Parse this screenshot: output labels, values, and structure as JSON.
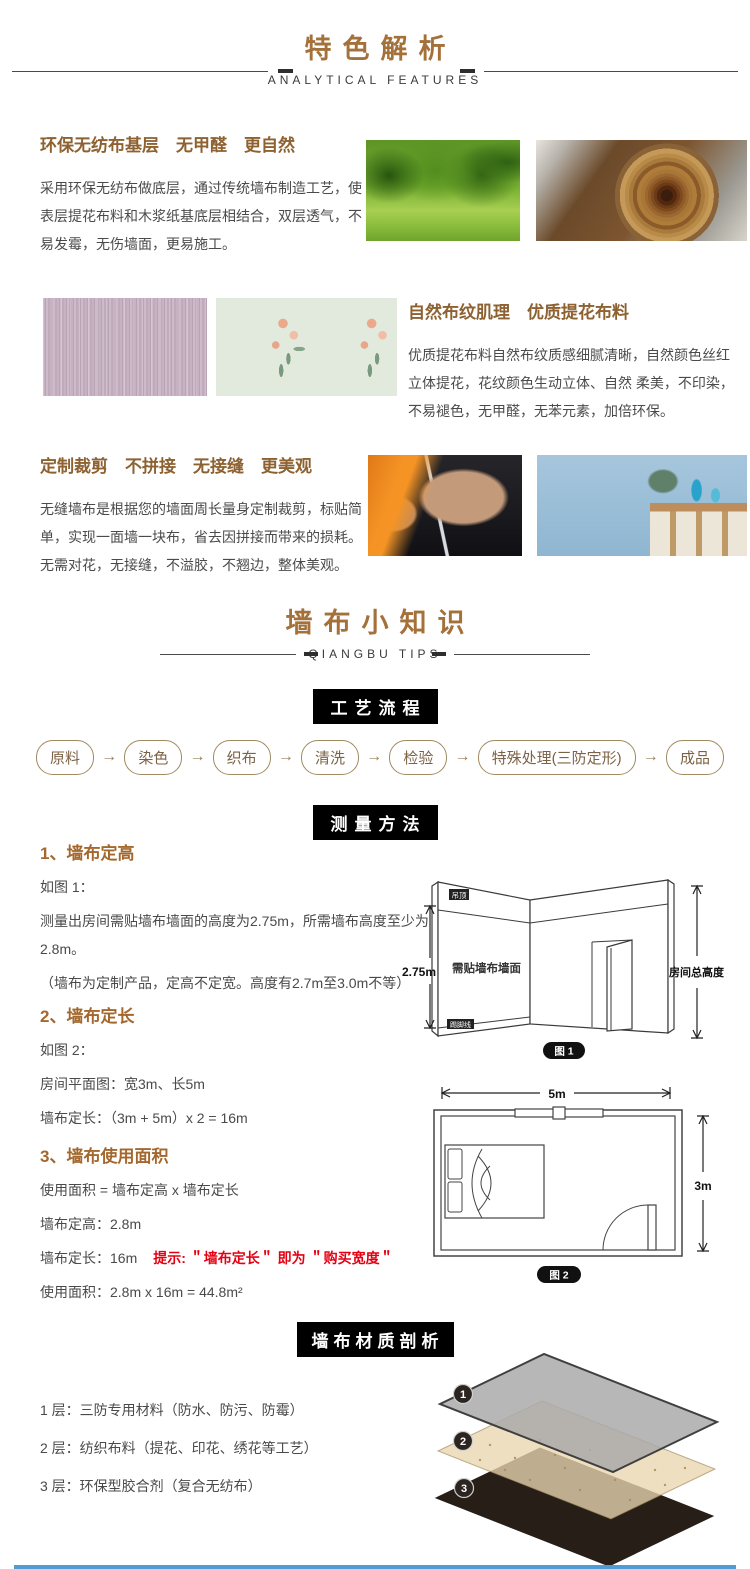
{
  "colors": {
    "accent_brown": "#a5713a",
    "heading_brown": "#8d6130",
    "body_text": "#4a4a4a",
    "tip_red": "#e60012",
    "header_box_bg": "#000000",
    "bottom_line_blue": "#4e9cd4"
  },
  "header1": {
    "title": "特色解析",
    "subtitle": "ANALYTICAL FEATURES"
  },
  "features": [
    {
      "title": "环保无纺布基层　无甲醛　更自然",
      "body": "采用环保无纺布做底层，通过传统墙布制造工艺，使表层提花布料和木浆纸基底层相结合，双层透气，不易发霉，无伤墙面，更易施工。",
      "images": [
        "green-trees-photo",
        "wood-log-rings-photo"
      ]
    },
    {
      "title": "自然布纹肌理　优质提花布料",
      "body": "优质提花布料自然布纹质感细腻清晰，自然颜色丝红立体提花，花纹颜色生动立体、自然 柔美，不印染，不易褪色，无甲醛，无苯元素，加倍环保。",
      "images": [
        "purple-fabric-texture-photo",
        "floral-fabric-pattern-photo"
      ]
    },
    {
      "title": "定制裁剪　不拼接　无接缝　更美观",
      "body": "无缝墙布是根据您的墙面周长量身定制裁剪，标贴简单，实现一面墙一块布，省去因拼接而带来的损耗。无需对花，无接缝，不溢胶，不翘边，整体美观。",
      "images": [
        "fabric-cutting-photo",
        "room-interior-photo"
      ]
    }
  ],
  "header2": {
    "title": "墙布小知识",
    "subtitle": "QIANGBU TIPS"
  },
  "process": {
    "header": "工艺流程",
    "steps": [
      "原料",
      "染色",
      "织布",
      "清洗",
      "检验",
      "特殊处理(三防定形)",
      "成品"
    ],
    "arrow": "→"
  },
  "measure": {
    "header": "测量方法",
    "s1": {
      "title": "1、墙布定高",
      "intro": "如图 1：",
      "p1": "测量出房间需贴墙布墙面的高度为2.75m，所需墙布高度至少为2.8m。",
      "p2": "（墙布为定制产品，定高不定宽。高度有2.7m至3.0m不等）"
    },
    "s2": {
      "title": "2、墙布定长",
      "intro": "如图 2：",
      "p1": "房间平面图：宽3m、长5m",
      "p2": "墙布定长：（3m + 5m）x 2 = 16m"
    },
    "s3": {
      "title": "3、墙布使用面积",
      "p1": "使用面积 = 墙布定高 x 墙布定长",
      "p2": "墙布定高：2.8m",
      "p3": "墙布定长：16m",
      "tip": "提示: ＂墙布定长＂ 即为 ＂购买宽度＂",
      "p4": "使用面积：2.8m x 16m = 44.8m²"
    },
    "fig1": {
      "caption": "图 1",
      "labels": {
        "ceiling": "吊顶",
        "wall": "需贴墙布墙面",
        "skirting": "踢脚线",
        "height": "2.75m",
        "total": "房间总高度"
      }
    },
    "fig2": {
      "caption": "图 2",
      "labels": {
        "width": "5m",
        "depth": "3m"
      }
    }
  },
  "material": {
    "header": "墙布材质剖析",
    "layers": [
      {
        "badge": "1",
        "text": "1 层：三防专用材料（防水、防污、防霉）"
      },
      {
        "badge": "2",
        "text": "2 层：纺织布料（提花、印花、绣花等工艺）"
      },
      {
        "badge": "3",
        "text": "3 层：环保型胶合剂（复合无纺布）"
      }
    ]
  }
}
